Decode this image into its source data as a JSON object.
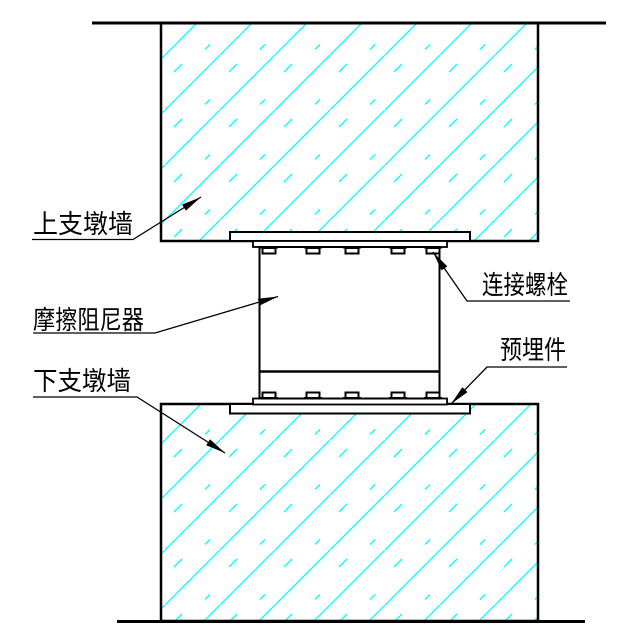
{
  "diagram": {
    "labels": {
      "upper_wall": "上支墩墙",
      "friction_damper": "摩擦阻尼器",
      "lower_wall": "下支墩墙",
      "connection_bolt": "连接螺栓",
      "embedded_part": "预埋件"
    },
    "colors": {
      "line": "#000000",
      "hatch": "#00ffff",
      "background": "#ffffff"
    }
  }
}
